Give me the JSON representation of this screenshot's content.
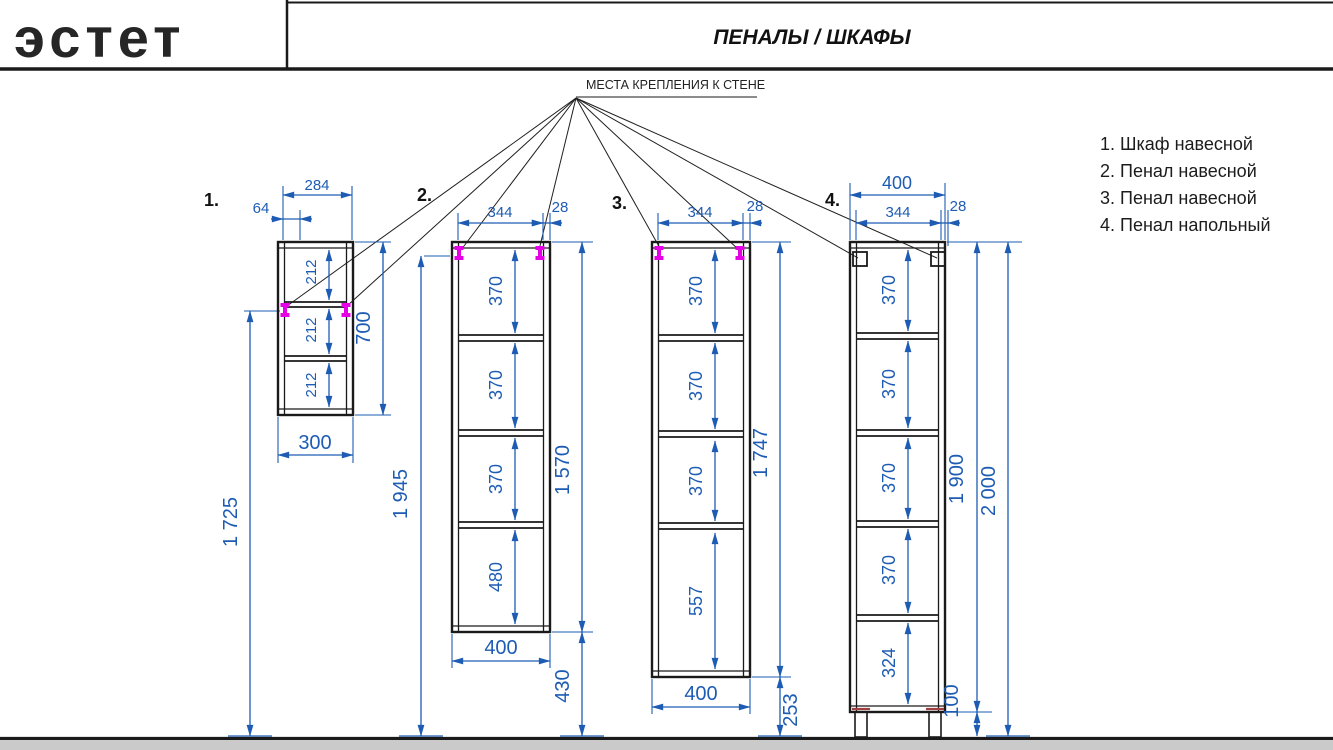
{
  "header": {
    "brand": "эстет",
    "title": "ПЕНАЛЫ / ШКАФЫ"
  },
  "mounting_note": "МЕСТА КРЕПЛЕНИЯ К СТЕНЕ",
  "legend": {
    "items": [
      "1. Шкаф навесной",
      "2. Пенал навесной",
      "3. Пенал навесной",
      "4. Пенал напольный"
    ]
  },
  "cabinets": [
    {
      "number": "1.",
      "dims": {
        "top_width": "284",
        "mount_offset": "64",
        "sections": [
          "212",
          "212",
          "212"
        ],
        "height": "700",
        "bottom_width": "300",
        "mount_to_floor": "1 725"
      }
    },
    {
      "number": "2.",
      "dims": {
        "top_width": "344",
        "edge": "28",
        "sections": [
          "370",
          "370",
          "370",
          "480"
        ],
        "height": "1 570",
        "mount_to_floor": "1 945",
        "bottom_width": "400",
        "floor_gap": "430"
      }
    },
    {
      "number": "3.",
      "dims": {
        "top_width": "344",
        "edge": "28",
        "sections": [
          "370",
          "370",
          "370",
          "557"
        ],
        "height": "1 747",
        "bottom_width": "400",
        "floor_gap": "253"
      }
    },
    {
      "number": "4.",
      "dims": {
        "outer_width": "400",
        "top_width": "344",
        "edge": "28",
        "sections": [
          "370",
          "370",
          "370",
          "370",
          "324"
        ],
        "height": "1 900",
        "total_height": "2 000",
        "legs": "100"
      }
    }
  ],
  "colors": {
    "dimension": "#1e5cb4",
    "fastener": "#e500e5",
    "floor": "#cacaca",
    "line": "#1a1a1a"
  }
}
